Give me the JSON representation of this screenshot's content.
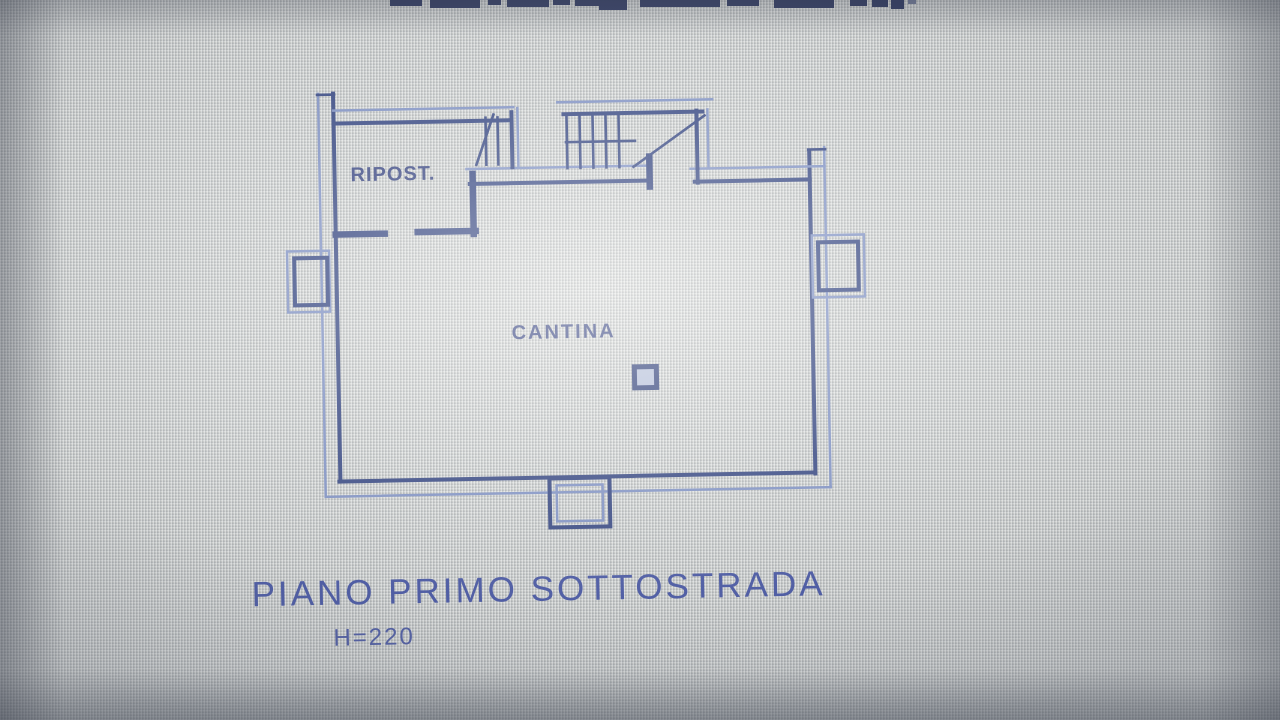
{
  "floorplan": {
    "rooms": [
      {
        "name": "RIPOST."
      },
      {
        "name": "CANTINA"
      }
    ],
    "caption": "PIANO PRIMO SOTTOSTRADA",
    "height_label": "H=220",
    "colors": {
      "wall_dark": "#31427e",
      "wall_light": "#7d8fc2",
      "label_blue": "#33407d",
      "caption_blue": "#4554a2",
      "background": "#c9cbc8",
      "cutoff_ink": "#26305a"
    }
  }
}
